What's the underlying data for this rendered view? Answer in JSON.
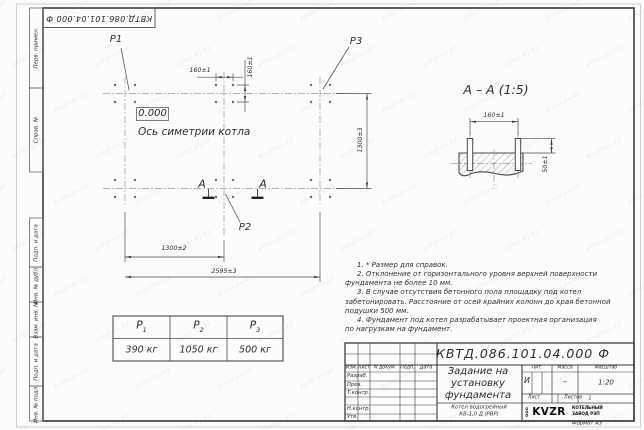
{
  "meta": {
    "watermark": "kotel-kv.kz",
    "format_label": "Формат А3"
  },
  "frame": {
    "top_stamp": "КВТД.086.101.04.000  Ф",
    "margin_labels": [
      "Перв. примен.",
      "Справ. №",
      "Подп. и дата",
      "Инв. № дубл.",
      "Взам. инв. №",
      "Подп. и дата",
      "Инв. № подл."
    ]
  },
  "plan": {
    "p1": "P1",
    "p2": "P2",
    "p3": "P3",
    "level_mark": "0.000",
    "axis_label": "Ось симетрии котла",
    "section_letter": "А",
    "dims": {
      "bolt_spacing_x": "160±1",
      "bolt_spacing_y": "160±1",
      "height": "1300±3",
      "half_width": "1300±2",
      "full_width": "2595±3"
    }
  },
  "section": {
    "title": "А – А (1:5)",
    "dims": {
      "bolt_spacing": "160±1",
      "protrusion": "50±1"
    }
  },
  "notes": [
    "1. * Размер для справок.",
    "2. Отклонение от горизонтального уровня верхней поверхности\nфундамента не более 10 мм.",
    "3. В случае отсутствия бетонного пола площадку под котел\nзабетонировать. Расстояние от осей крайних колонн до края бетонной\nподушки 500 мм.",
    "4. Фундамент под котел разрабатывает проектная организация\nпо нагрузкам на фундамент."
  ],
  "load_table": {
    "headers": [
      {
        "base": "P",
        "sub": "1"
      },
      {
        "base": "P",
        "sub": "2"
      },
      {
        "base": "P",
        "sub": "3"
      }
    ],
    "values": [
      "390 кг",
      "1050 кг",
      "500 кг"
    ]
  },
  "title_block": {
    "designation": "КВТД.086.101.04.000  Ф",
    "doc_title_lines": [
      "Задание на",
      "установку",
      "фундамента"
    ],
    "product_lines": [
      "Котел водогрейный",
      "КВ-1,0 Д (РВР)"
    ],
    "header_cols": [
      "Изм.",
      "Лист",
      "N докум.",
      "Подп.",
      "Дата"
    ],
    "row_labels": [
      "Разраб.",
      "Пров.",
      "Т.контр.",
      "Н.контр.",
      "Утв."
    ],
    "lit_label": "Лит.",
    "lit_value": "И",
    "mass_label": "Масса",
    "mass_value": "–",
    "scale_label": "Масштаб",
    "scale_value": "1:20",
    "sheet_label": "Лист",
    "sheets_label": "Листов",
    "sheets_value": "1",
    "company": {
      "ooo": "ООО",
      "logo": "KVZR",
      "line1": "КОТЕЛЬНЫЙ",
      "line2": "ЗАВОД РЭП"
    }
  }
}
